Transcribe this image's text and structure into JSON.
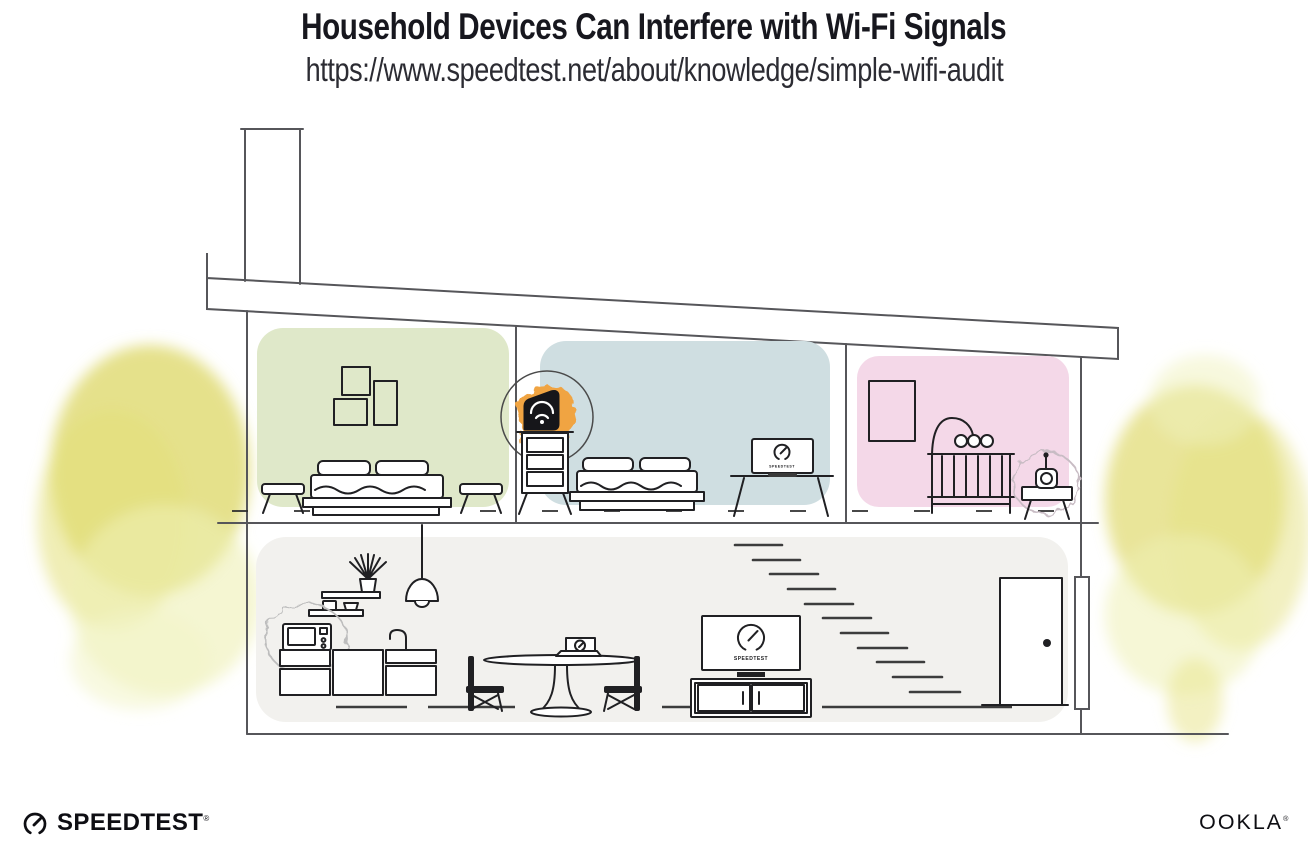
{
  "header": {
    "title": "Household Devices Can Interfere with Wi-Fi Signals",
    "url": "https://www.speedtest.net/about/knowledge/simple-wifi-audit"
  },
  "illustration": {
    "type": "house cross-section diagram",
    "screens": {
      "bedroom_laptop_brand": "SPEEDTEST",
      "living_room_tv_brand": "SPEEDTEST"
    },
    "highlighted_device": "wifi-router",
    "interference_sources": [
      "microwave-oven",
      "baby-monitor"
    ],
    "icons": [
      "wifi-router-icon",
      "spotlight-circle",
      "microwave-icon",
      "baby-monitor-icon",
      "interference-burst",
      "bed",
      "nightstand",
      "picture-frames",
      "dresser",
      "desk-laptop",
      "crib",
      "crib-mobile",
      "side-table",
      "pendant-lamp",
      "kitchen-shelves",
      "plant",
      "sink-faucet",
      "dining-table",
      "dining-laptop",
      "chair",
      "tv",
      "media-console",
      "stairs",
      "door",
      "downspout",
      "tree",
      "chimney",
      "roof"
    ],
    "rooms": [
      {
        "name": "bedroom-green",
        "wall_color": "#dfe8c9"
      },
      {
        "name": "bedroom-blue",
        "wall_color": "#cfdee1"
      },
      {
        "name": "nursery-pink",
        "wall_color": "#f4d8e8"
      },
      {
        "name": "living-area-gray",
        "wall_color": "#f2f1ee"
      }
    ]
  },
  "footer": {
    "speedtest_wordmark": "SPEEDTEST",
    "speedtest_reg_mark": "®",
    "ookla_wordmark": "OOKLA",
    "ookla_reg_mark": "®"
  },
  "colors": {
    "title": "#17171e",
    "url-text": "#2c2c33",
    "line": "#56565a",
    "ink": "#202023",
    "room-green": "#dfe8c9",
    "room-blue": "#cfdee1",
    "room-pink": "#f4d8e8",
    "room-gray": "#f2f1ee",
    "accent-orange": "#f0a443",
    "tree-yellow": "#dfda6e",
    "tree-light": "#eff0b4",
    "logo-ink": "#0e0e13"
  }
}
